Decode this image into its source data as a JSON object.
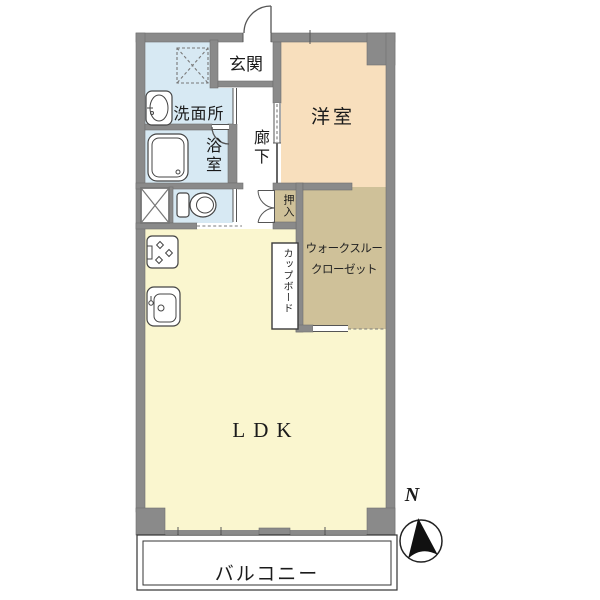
{
  "rooms": {
    "entrance": "玄関",
    "washroom": "洗面所",
    "bathroom": "浴室",
    "corridor": "廊下",
    "western_room": "洋室",
    "futon_closet": "押入",
    "wtc_line1": "ウォークスルー",
    "wtc_line2": "クローゼット",
    "cupboard": "カップボード",
    "ldk": "LDK",
    "balcony": "バルコニー"
  },
  "compass": {
    "north": "N"
  },
  "colors": {
    "wall": "#8a8a8a",
    "water_blue": "#d7e9f3",
    "room_peach": "#f8dfbd",
    "closet_tan": "#cfc199",
    "ldk_yellow": "#faf6cf",
    "line": "#555555"
  },
  "icons": [
    "north-arrow",
    "entry-door-arc",
    "double-closet-door",
    "bathtub",
    "wash-basin",
    "washing-machine-pan",
    "toilet",
    "pipe-shaft",
    "gas-stove",
    "kitchen-sink",
    "window-ticks"
  ]
}
